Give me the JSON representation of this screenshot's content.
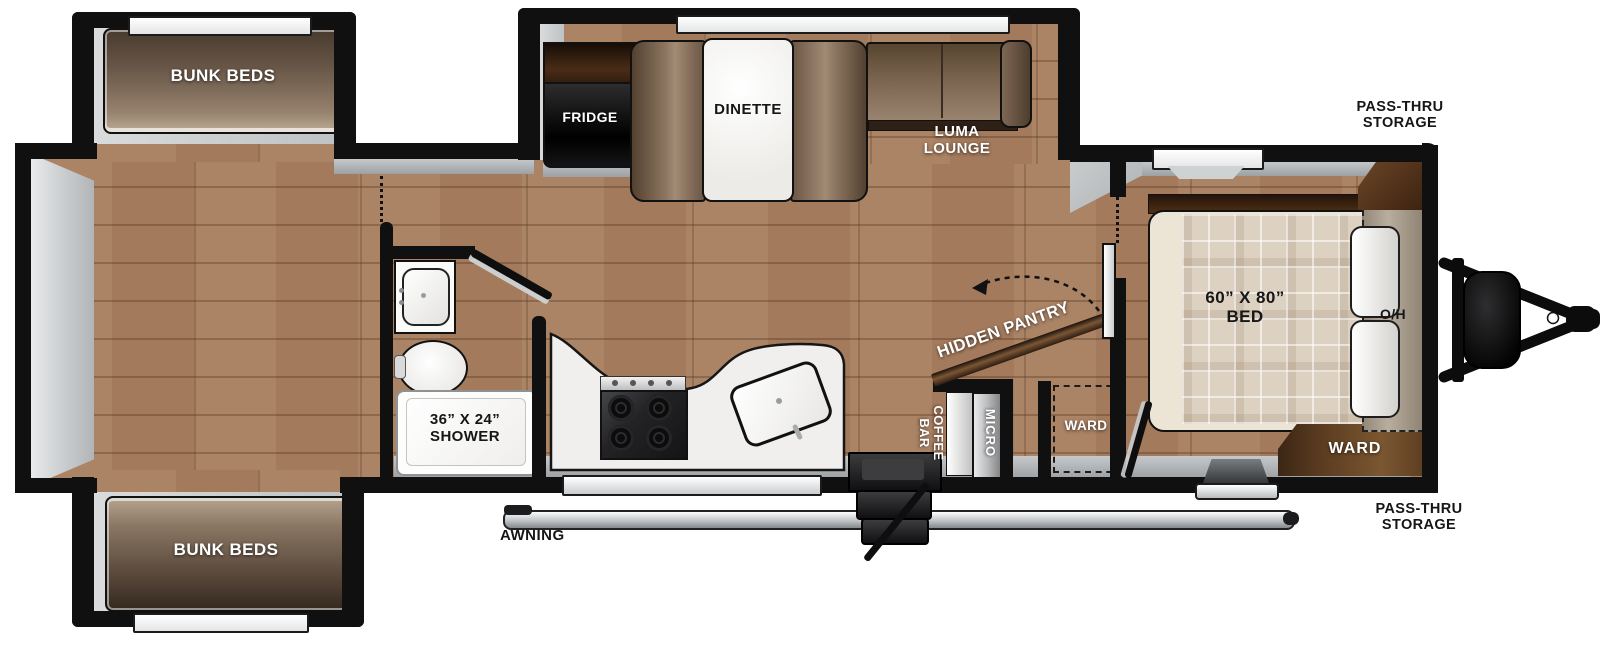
{
  "labels": {
    "bunk_top": "BUNK BEDS",
    "bunk_bottom": "BUNK BEDS",
    "fridge": "FRIDGE",
    "dinette": "DINETTE",
    "luma_lounge": "LUMA\nLOUNGE",
    "pass_thru_top": "PASS-THRU\nSTORAGE",
    "pass_thru_bottom": "PASS-THRU\nSTORAGE",
    "bed": "60” X 80”\nBED",
    "overhead": "O/H",
    "ward_bed": "WARD",
    "ward_hall": "WARD",
    "hidden_pantry": "HIDDEN PANTRY",
    "coffee_bar": "COFFEE\nBAR",
    "micro": "MICRO",
    "shower": "36” X 24”\nSHOWER",
    "awning": "AWNING"
  },
  "colors": {
    "wall": "#101010",
    "floor": "#a87e5f",
    "trim_gray": "#b9bcbe",
    "cabinet_brown": "#5f3f22",
    "counter_white": "#f0efed",
    "bed_plaid": "#ddd2c2"
  }
}
